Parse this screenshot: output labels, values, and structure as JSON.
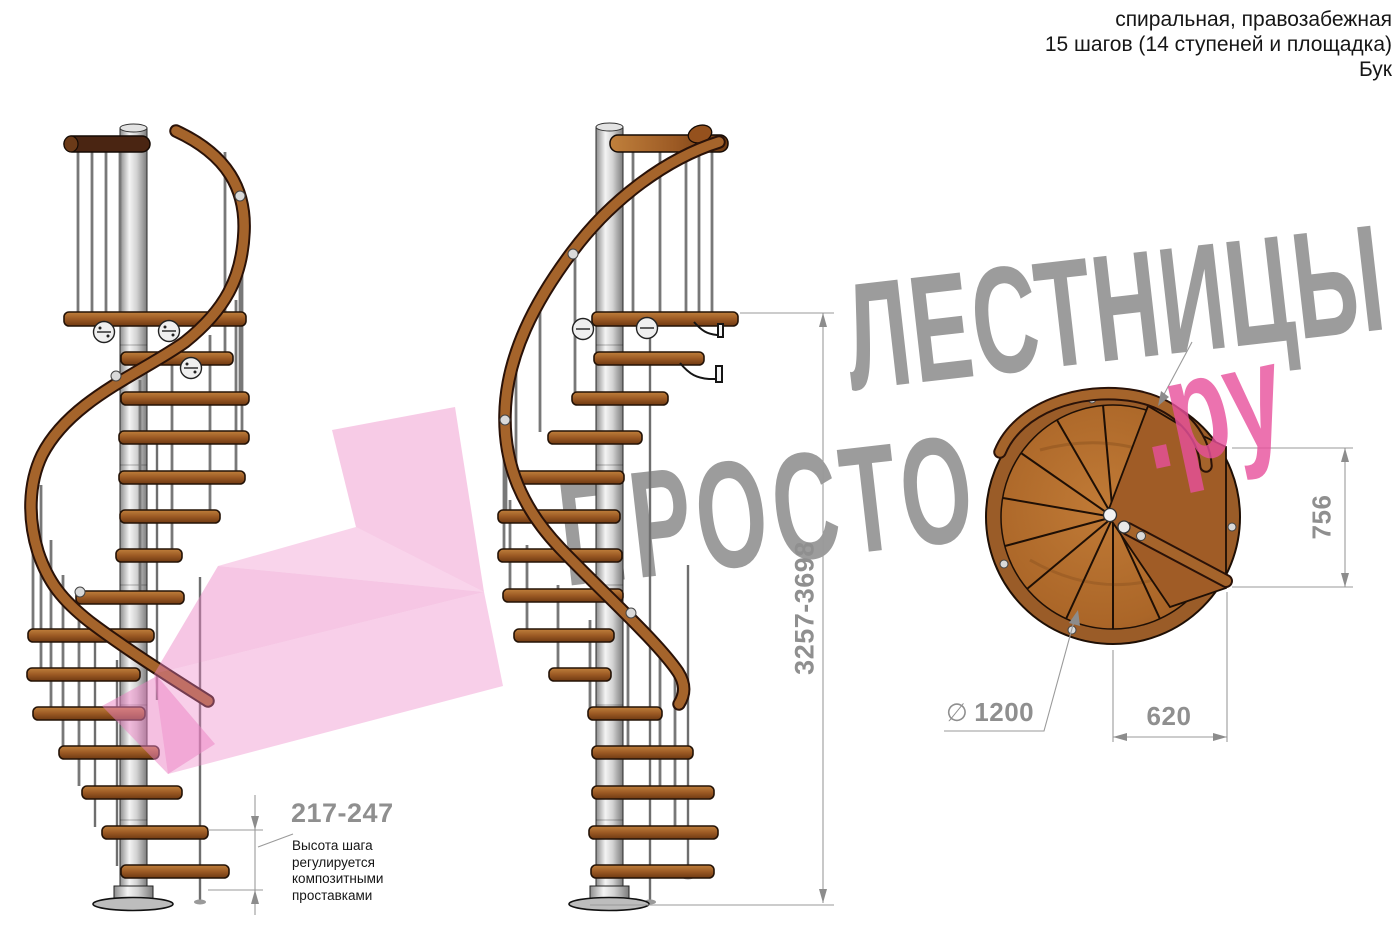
{
  "header": {
    "line1": "спиральная, правозабежная",
    "line2": "15 шагов (14 ступеней и площадка)",
    "line3": "Бук"
  },
  "watermark": {
    "word_top": "ЛЕСТНИЦЫ",
    "word_bottom": "ПРОСТО",
    "suffix": ".ру",
    "gray_color": "#9c9c9c",
    "pink_color": "#e8509c"
  },
  "dimensions": {
    "total_height": {
      "value": "3257-3698"
    },
    "step_height": {
      "value": "217-247",
      "note_lines": [
        "Высота шага",
        "регулируется",
        "композитными",
        "проставками"
      ]
    },
    "plan_depth": {
      "value": "756"
    },
    "plan_width": {
      "value": "620"
    },
    "diameter": {
      "symbol": "∅",
      "value": "1200"
    }
  },
  "drawing": {
    "wood_color": "#a05a24",
    "metal_color": "#cccccc",
    "outline_color": "#1e0f05",
    "dim_color": "#8f8f8f"
  }
}
